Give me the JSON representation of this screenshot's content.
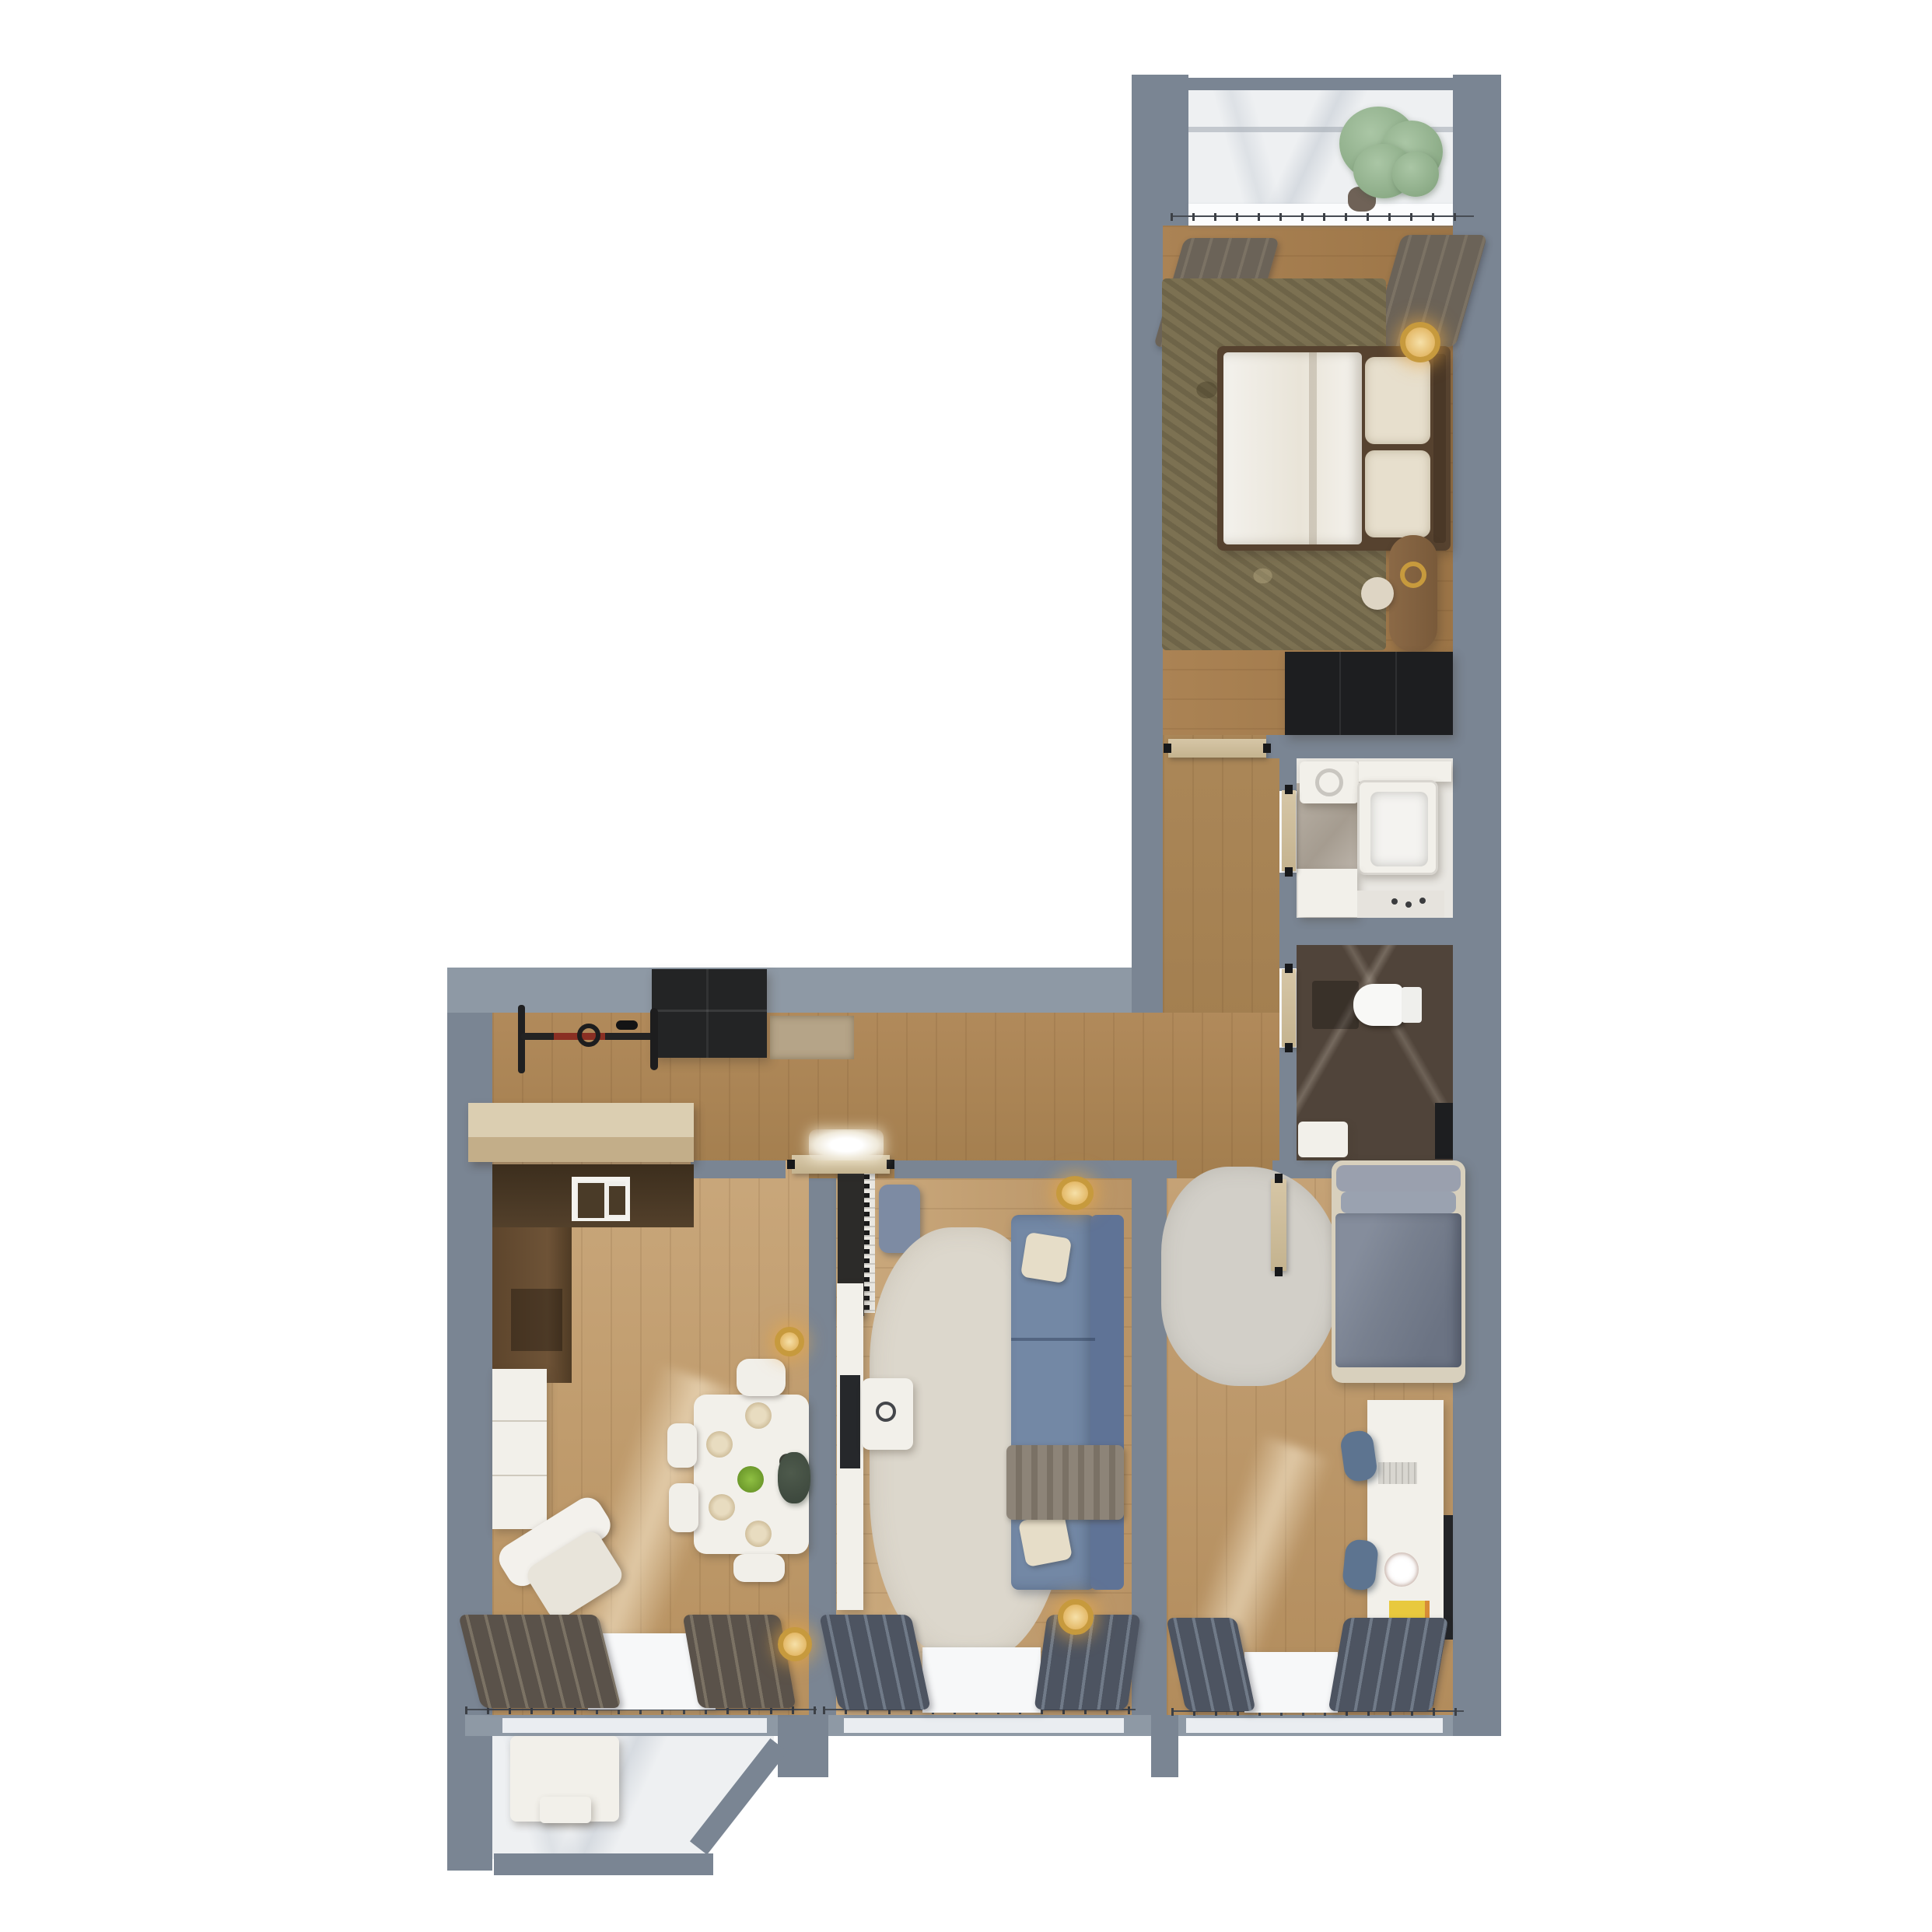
{
  "image": {
    "kind": "3d-floor-plan-render",
    "description": "Top-down 3D rendering of a two-bedroom apartment floor plan on a white background",
    "orientation": "L-shaped layout: tall wing on the right, wide wing at the bottom left"
  },
  "palette": {
    "wall": "#7a8593",
    "wall_light": "#8e99a5",
    "wc1": "#c9a77b",
    "wc2": "#b6905f",
    "marble": "#eef0f2",
    "bath_tile": "#b3aba0",
    "wc_tile": "#50443a",
    "rug_olive": "#7c7152",
    "rug_cream": "#dcd7cc",
    "rug_gray": "#d2cfc8",
    "furn_white": "#f2f0ea",
    "cream": "#e7dfcd",
    "door": "#d6c6a6",
    "dark": "#1d1e20",
    "wood_dark": "#42321f",
    "wood_mid": "#64492f",
    "table_wood": "#8b6946",
    "sofa": "#7388a5",
    "sofa_dark": "#5f7396",
    "bed2_duvet": "#78808f",
    "bed2_head": "#9aa0ae",
    "curtain_dark": "#4d5461",
    "curtain_brown": "#5a524a",
    "gold": "#c79a3d",
    "plant": "#aac6a5",
    "plant_dark": "#7fa07a",
    "foliage_dark": "#4e5a4c",
    "chair_blue": "#5d7490",
    "accent_red": "#8a2f23",
    "sun": "#fff3da"
  },
  "rooms": {
    "loggia": {
      "label": "Loggia balcony with decorative plant",
      "furniture": [
        "potted-plant",
        "window-sill"
      ]
    },
    "bedroom1": {
      "label": "Master bedroom with double bed",
      "furniture": [
        "double-bed",
        "pillows",
        "area-rug",
        "bedside-lamp",
        "vanity-desk",
        "stool",
        "wardrobe",
        "curtains"
      ]
    },
    "bathroom": {
      "label": "Bathroom with bathtub",
      "furniture": [
        "washing-machine",
        "bathtub",
        "sink-counter",
        "cabinet"
      ]
    },
    "wc": {
      "label": "Toilet room",
      "furniture": [
        "toilet",
        "sink",
        "tall-cabinet"
      ]
    },
    "hallway": {
      "label": "Entry hallway",
      "furniture": [
        "wall-mounted-bicycle",
        "entry-cabinet",
        "doormat",
        "shoe-bench"
      ]
    },
    "kitchen_dining": {
      "label": "Kitchen and dining room",
      "furniture": [
        "kitchen-counter",
        "cooktop",
        "tall-cabinet",
        "base-cabinet",
        "dining-table",
        "chairs",
        "pendant-lamp",
        "armchair",
        "curtains",
        "floor-lamp"
      ]
    },
    "living": {
      "label": "Living room",
      "furniture": [
        "upright-piano",
        "piano-bench",
        "media-console",
        "tv",
        "coffee-table",
        "area-rug",
        "sofa",
        "pendant-lamp",
        "curtains",
        "floor-lamp"
      ]
    },
    "bedroom2": {
      "label": "Second bedroom with desk",
      "furniture": [
        "single-bed",
        "area-rug",
        "desk",
        "desk-chairs",
        "toy-box",
        "curtains"
      ]
    },
    "balcony": {
      "label": "Lower balcony with bench seating",
      "furniture": [
        "bench-sofa"
      ]
    }
  }
}
